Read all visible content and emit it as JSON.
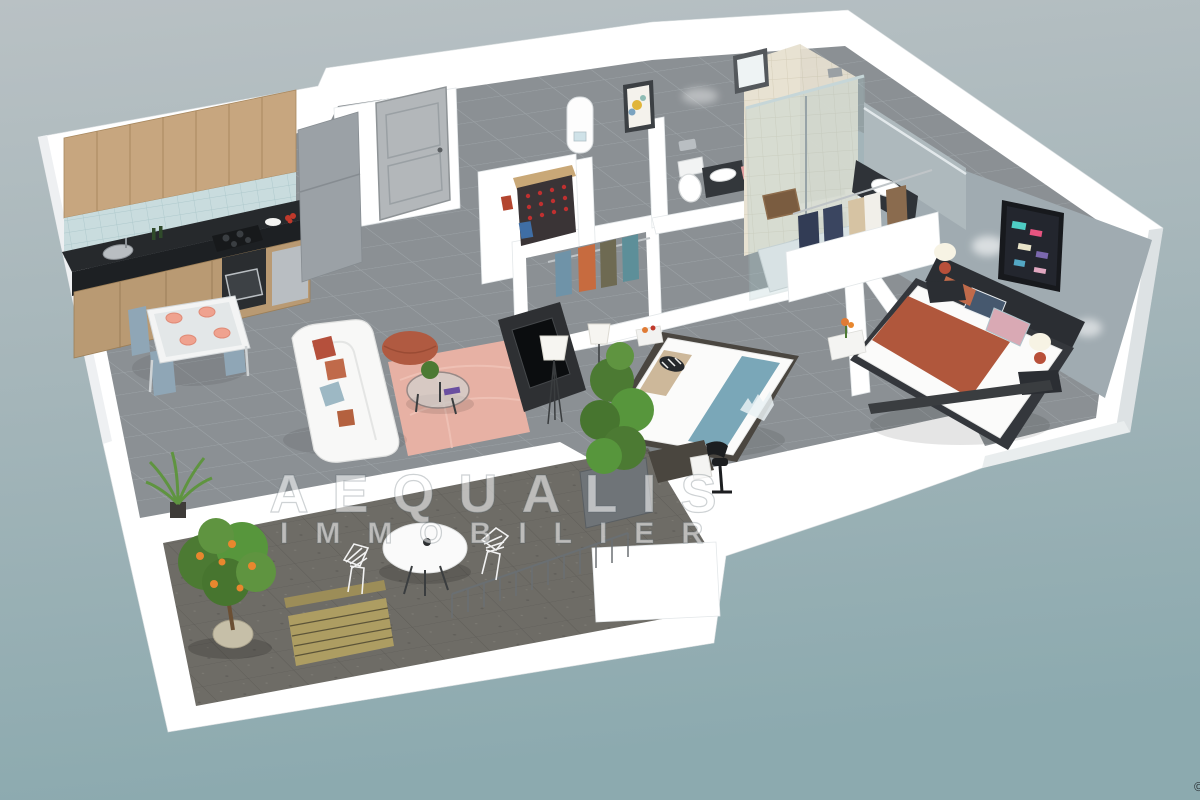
{
  "watermark": {
    "line1": "AEQUALIS",
    "line2": "IMMOBILIER"
  },
  "corner_mark": "©",
  "colors": {
    "bg_top": "#b9c1c4",
    "bg_mid": "#a6b6ba",
    "bg_bottom": "#8caaaf",
    "wall_white": "#ffffff",
    "wall_shade": "#e7ebed",
    "wall_face_right": "#dde2e4",
    "floor_tile": "#8b9094",
    "floor_grout": "#9da3a7",
    "terrace_floor": "#6e6c66",
    "terrace_grid": "#5f5d58",
    "accent_wall": "#a0abb1",
    "wood_cabinet": "#c7a67f",
    "wood_dark": "#a8885f",
    "counter_black": "#26292c",
    "backsplash_blue": "#c9dcde",
    "fridge_gray": "#9ba1a6",
    "steel": "#b9bec2",
    "door_gray": "#b3b7ba",
    "sofa_white": "#f8f8f7",
    "rug_pink": "#e7b1a4",
    "pouf_terracotta": "#b05a41",
    "plate_salmon": "#efa28f",
    "chair_bluegray": "#8fa6b6",
    "bed_throw": "#b0573c",
    "bed_blue_runner": "#7aa7b8",
    "pillow_navy": "#46586e",
    "pillow_pink": "#d9a9b4",
    "lamp_red": "#b8503a",
    "art_dark": "#23262e",
    "plant_green": "#4c7a33",
    "plant_light": "#5f9440",
    "orange_fruit": "#e8872e",
    "pot_beige": "#c6bfa8",
    "bench_wood": "#ad9d62",
    "glass_teal": "#aecdd0",
    "tile_beige": "#e8e2d2",
    "mat_brown": "#7a5c40",
    "clothes_navy": "#323c55",
    "clothes_beige": "#d6c3a3",
    "clothes_brown": "#8a6b4e",
    "clothes_orange": "#c76b3f",
    "clothes_olive": "#6e6a52",
    "clothes_teal": "#5d8f99",
    "clothes_blue": "#6f93a8"
  },
  "scene": {
    "style": "3d-isometric-apartment-floorplan-render",
    "rooms": [
      {
        "name": "kitchen",
        "objects": [
          "wood upper cabinets",
          "tiled backsplash",
          "black countertop",
          "sink",
          "hob",
          "oven",
          "dishwasher",
          "fridge",
          "wine bottles",
          "fruit plate"
        ]
      },
      {
        "name": "dining-area",
        "objects": [
          "dining table",
          "4 chairs",
          "4 salmon place settings"
        ]
      },
      {
        "name": "living-room",
        "objects": [
          "white sofa with cushions",
          "terracotta pouf",
          "pink rug",
          "glass coffee table",
          "tv unit",
          "floor lamp",
          "houseplant"
        ]
      },
      {
        "name": "entry",
        "objects": [
          "front door",
          "wine rack",
          "water heater",
          "framed picture"
        ]
      },
      {
        "name": "hallway-closet",
        "objects": [
          "clothes rail with garments"
        ]
      },
      {
        "name": "wc",
        "objects": [
          "toilet",
          "small vanity",
          "pink towel"
        ]
      },
      {
        "name": "bathroom",
        "objects": [
          "walk-in glass shower",
          "beige tiles",
          "vanity with basin",
          "mirror",
          "bath mat",
          "window"
        ]
      },
      {
        "name": "walk-in-closet",
        "objects": [
          "hanging coats",
          "white parapet wall"
        ]
      },
      {
        "name": "master-bedroom",
        "objects": [
          "double bed with terracotta throw",
          "patterned pillows",
          "dark headboard",
          "two nightstands",
          "red bedside lamps",
          "geometric wall art",
          "blue-grey accent wall",
          "foot bench"
        ]
      },
      {
        "name": "bedroom-2",
        "objects": [
          "bed with blue runner",
          "beige pillow",
          "striped bolster",
          "desk",
          "desk chair",
          "drawer unit",
          "console with orange flowers",
          "floor lamp"
        ]
      },
      {
        "name": "terrace",
        "objects": [
          "concrete floor",
          "orange tree in pot",
          "round table",
          "wire chairs",
          "wooden bench",
          "railing posts",
          "bamboo planter"
        ]
      }
    ]
  }
}
